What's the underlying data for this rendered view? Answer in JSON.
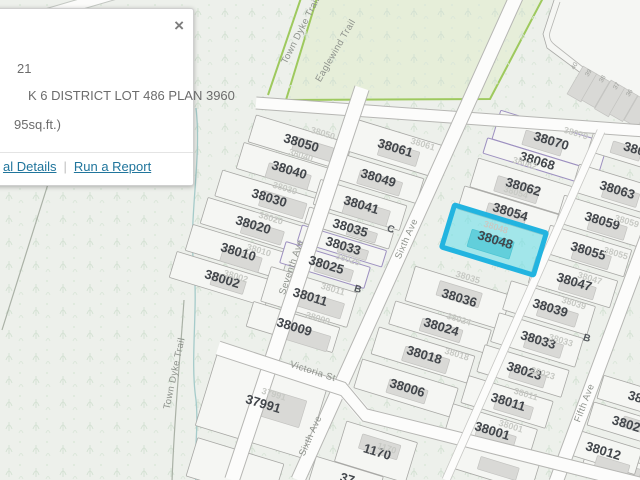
{
  "popup": {
    "close": "×",
    "line1": "21",
    "line2": "K 6 DISTRICT LOT 486 PLAN 3960",
    "line3": "95sq.ft.)",
    "links": {
      "details": "al Details",
      "separator": "|",
      "report": "Run a Report"
    }
  },
  "map": {
    "colors": {
      "highlight_stroke": "#22b4e0",
      "highlight_fill": "#65dfe9",
      "park_fill": "#e6eed9",
      "park_stroke": "#9ec95e",
      "link_blue": "#20759c",
      "background": "#edf0eb"
    },
    "highlighted_parcel": "38048",
    "lots": [
      {
        "n": "38050",
        "x": 300,
        "y": 143,
        "w": 100,
        "h": 28,
        "b": [
          14,
          2,
          40,
          14
        ]
      },
      {
        "n": "38040",
        "x": 288,
        "y": 170,
        "w": 100,
        "h": 27,
        "b": [
          2,
          6,
          44,
          15
        ]
      },
      {
        "n": "38030",
        "x": 268,
        "y": 198,
        "w": 103,
        "h": 27,
        "b": [
          16,
          2,
          46,
          16
        ]
      },
      {
        "n": "38020",
        "x": 252,
        "y": 225,
        "w": 100,
        "h": 27,
        "b": [
          12,
          4,
          42,
          14
        ]
      },
      {
        "n": "38010",
        "x": 237,
        "y": 252,
        "w": 100,
        "h": 27,
        "b": [
          6,
          6,
          40,
          15
        ]
      },
      {
        "n": "38002",
        "x": 221,
        "y": 279,
        "w": 100,
        "h": 27,
        "b": [
          8,
          2,
          34,
          13
        ]
      },
      {
        "n": "38061",
        "x": 394,
        "y": 148,
        "w": 92,
        "h": 33,
        "b": [
          6,
          4,
          40,
          15
        ]
      },
      {
        "n": "38049",
        "x": 377,
        "y": 178,
        "w": 90,
        "h": 26,
        "b": [
          4,
          4,
          44,
          14
        ]
      },
      {
        "n": "38041",
        "x": 360,
        "y": 205,
        "w": 90,
        "h": 26,
        "b": [
          8,
          5,
          46,
          16
        ]
      },
      {
        "n": "38035",
        "x": 349,
        "y": 228,
        "w": 88,
        "h": 17,
        "b": [
          14,
          2,
          30,
          10
        ]
      },
      {
        "n": "38033",
        "x": 342,
        "y": 246,
        "w": 88,
        "h": 17,
        "p": 1,
        "b": [
          12,
          2,
          30,
          10
        ]
      },
      {
        "n": "38025",
        "x": 325,
        "y": 265,
        "w": 88,
        "h": 22,
        "p": 1,
        "b": [
          10,
          3,
          38,
          12
        ]
      },
      {
        "n": "38011",
        "x": 309,
        "y": 297,
        "w": 90,
        "h": 36,
        "b": [
          12,
          4,
          48,
          16
        ]
      },
      {
        "n": "38009",
        "x": 293,
        "y": 327,
        "w": 90,
        "h": 26,
        "b": [
          14,
          6,
          50,
          16
        ]
      },
      {
        "n": "38070",
        "x": 550,
        "y": 141,
        "w": 112,
        "h": 30,
        "p": 1,
        "b": [
          -6,
          4,
          40,
          15
        ]
      },
      {
        "n": "38068",
        "x": 536,
        "y": 161,
        "w": 106,
        "h": 16,
        "p": 1
      },
      {
        "n": "38062",
        "x": 522,
        "y": 187,
        "w": 100,
        "h": 30,
        "b": [
          -4,
          4,
          44,
          16
        ]
      },
      {
        "n": "38054",
        "x": 509,
        "y": 212,
        "w": 100,
        "h": 24,
        "b": [
          -2,
          4,
          40,
          14
        ]
      },
      {
        "n": "38048",
        "x": 494,
        "y": 240,
        "w": 96,
        "h": 44,
        "hl": 1,
        "b": [
          -2,
          5,
          44,
          18
        ]
      },
      {
        "n": "38036",
        "x": 458,
        "y": 298,
        "w": 100,
        "h": 36,
        "b": [
          0,
          -4,
          44,
          15
        ]
      },
      {
        "n": "38024",
        "x": 440,
        "y": 327,
        "w": 100,
        "h": 24,
        "b": [
          2,
          3,
          42,
          13
        ]
      },
      {
        "n": "38018",
        "x": 423,
        "y": 355,
        "w": 100,
        "h": 28,
        "b": [
          4,
          4,
          46,
          15
        ]
      },
      {
        "n": "38006",
        "x": 406,
        "y": 388,
        "w": 100,
        "h": 30,
        "b": [
          2,
          3,
          40,
          14
        ]
      },
      {
        "n": "380",
        "x": 633,
        "y": 149,
        "w": 85,
        "h": 30,
        "b": [
          -6,
          4,
          30,
          12
        ]
      },
      {
        "n": "38063",
        "x": 616,
        "y": 190,
        "w": 85,
        "h": 28,
        "b": [
          6,
          4,
          36,
          14
        ]
      },
      {
        "n": "38059",
        "x": 601,
        "y": 221,
        "w": 85,
        "h": 28,
        "b": [
          8,
          5,
          38,
          14
        ]
      },
      {
        "n": "38055",
        "x": 587,
        "y": 251,
        "w": 85,
        "h": 28,
        "b": [
          6,
          5,
          38,
          14
        ]
      },
      {
        "n": "38047",
        "x": 573,
        "y": 282,
        "w": 85,
        "h": 28,
        "b": [
          6,
          5,
          36,
          13
        ]
      },
      {
        "n": "38039",
        "x": 549,
        "y": 308,
        "w": 88,
        "h": 30,
        "b": [
          10,
          4,
          40,
          14
        ]
      },
      {
        "n": "38033",
        "x": 537,
        "y": 340,
        "w": 88,
        "h": 30,
        "b": [
          8,
          4,
          38,
          14
        ]
      },
      {
        "n": "38023",
        "x": 523,
        "y": 371,
        "w": 88,
        "h": 28,
        "b": [
          6,
          4,
          36,
          13
        ]
      },
      {
        "n": "38011",
        "x": 507,
        "y": 402,
        "w": 88,
        "h": 28,
        "b": [
          8,
          4,
          38,
          13
        ]
      },
      {
        "n": "38001",
        "x": 491,
        "y": 431,
        "w": 88,
        "h": 30,
        "b": [
          6,
          5,
          40,
          14
        ]
      },
      {
        "n": "37991",
        "x": 262,
        "y": 404,
        "w": 115,
        "h": 80,
        "b": [
          16,
          -2,
          52,
          28
        ]
      },
      {
        "n": "1170",
        "x": 376,
        "y": 452,
        "w": 74,
        "h": 42,
        "b": [
          2,
          -6,
          40,
          15
        ]
      },
      {
        "n": "37",
        "x": 346,
        "y": 479,
        "w": 70,
        "h": 26
      },
      {
        "n": "",
        "x": 235,
        "y": 470,
        "w": 90,
        "h": 40
      },
      {
        "n": "",
        "x": 497,
        "y": 466,
        "w": 80,
        "h": 30,
        "b": [
          2,
          2,
          40,
          13
        ]
      },
      {
        "n": "",
        "x": 620,
        "y": 472,
        "w": 76,
        "h": 28,
        "b": [
          2,
          -2,
          36,
          13
        ]
      },
      {
        "n": "38",
        "x": 634,
        "y": 397,
        "w": 70,
        "h": 24
      },
      {
        "n": "3802",
        "x": 625,
        "y": 424,
        "w": 72,
        "h": 24,
        "b": [
          10,
          -2,
          26,
          11
        ]
      },
      {
        "n": "38012",
        "x": 602,
        "y": 451,
        "w": 76,
        "h": 26,
        "b": [
          14,
          12,
          34,
          13
        ]
      }
    ],
    "faint_labels": [
      {
        "t": "38050",
        "x": 322,
        "y": 136
      },
      {
        "t": "38040",
        "x": 300,
        "y": 158
      },
      {
        "t": "38030",
        "x": 284,
        "y": 191
      },
      {
        "t": "38020",
        "x": 270,
        "y": 221
      },
      {
        "t": "38010",
        "x": 258,
        "y": 253
      },
      {
        "t": "38002",
        "x": 235,
        "y": 279
      },
      {
        "t": "38061",
        "x": 422,
        "y": 147
      },
      {
        "t": "38025",
        "x": 347,
        "y": 262
      },
      {
        "t": "38011",
        "x": 332,
        "y": 292
      },
      {
        "t": "38009",
        "x": 317,
        "y": 321
      },
      {
        "t": "38070",
        "x": 575,
        "y": 136
      },
      {
        "t": "38062",
        "x": 524,
        "y": 166
      },
      {
        "t": "38054",
        "x": 515,
        "y": 195
      },
      {
        "t": "38048",
        "x": 495,
        "y": 230
      },
      {
        "t": "38035",
        "x": 467,
        "y": 280
      },
      {
        "t": "38024",
        "x": 458,
        "y": 322
      },
      {
        "t": "38018",
        "x": 456,
        "y": 357
      },
      {
        "t": "38011",
        "x": 525,
        "y": 397
      },
      {
        "t": "38001",
        "x": 510,
        "y": 429
      },
      {
        "t": "38059",
        "x": 626,
        "y": 224
      },
      {
        "t": "38055",
        "x": 615,
        "y": 256
      },
      {
        "t": "38047",
        "x": 589,
        "y": 281
      },
      {
        "t": "38039",
        "x": 573,
        "y": 306
      },
      {
        "t": "38033",
        "x": 560,
        "y": 343
      },
      {
        "t": "38023",
        "x": 542,
        "y": 376
      },
      {
        "t": "37991",
        "x": 273,
        "y": 397
      },
      {
        "t": "1170",
        "x": 386,
        "y": 451
      }
    ],
    "street_labels": [
      {
        "t": "Seventh Ave",
        "x": 294,
        "y": 268,
        "r": -71
      },
      {
        "t": "Sixth Ave",
        "x": 409,
        "y": 240,
        "r": -66
      },
      {
        "t": "Sixth Ave",
        "x": 313,
        "y": 437,
        "r": -66
      },
      {
        "t": "Fifth Ave",
        "x": 587,
        "y": 404,
        "r": -69
      },
      {
        "t": "Victoria St",
        "x": 312,
        "y": 374,
        "r": 18
      },
      {
        "t": "Eaglewind Trail",
        "x": 338,
        "y": 52,
        "r": -60
      },
      {
        "t": "Town Dyke Trail",
        "x": 303,
        "y": 32,
        "r": -63
      },
      {
        "t": "Town Dyke Trail",
        "x": 177,
        "y": 374,
        "r": -78
      }
    ],
    "unit_labels": [
      {
        "t": "40",
        "x": 576,
        "y": 67,
        "r": -58
      },
      {
        "t": "39",
        "x": 590,
        "y": 74,
        "r": -58
      },
      {
        "t": "38",
        "x": 604,
        "y": 80,
        "r": -58
      },
      {
        "t": "37",
        "x": 618,
        "y": 87,
        "r": -58
      },
      {
        "t": "36",
        "x": 631,
        "y": 94,
        "r": -58
      }
    ],
    "letter_labels": [
      {
        "t": "C",
        "x": 390,
        "y": 232
      },
      {
        "t": "B",
        "x": 357,
        "y": 292
      },
      {
        "t": "B",
        "x": 586,
        "y": 341
      }
    ]
  }
}
